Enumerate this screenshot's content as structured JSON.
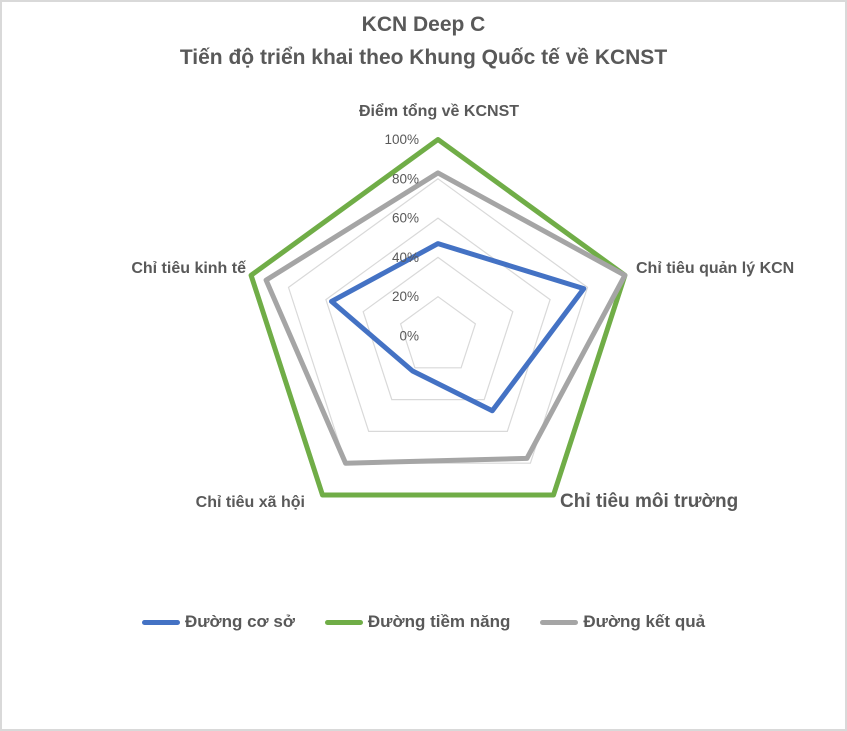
{
  "chart_data": {
    "type": "radar",
    "title": "KCN Deep C",
    "subtitle": "Tiến độ triển khai theo Khung Quốc tế về KCNST",
    "categories": [
      "Điểm tổng về KCNST",
      "Chỉ tiêu quản lý KCN",
      "Chỉ tiêu môi trường",
      "Chỉ tiêu xã hội",
      "Chỉ tiêu kinh tế"
    ],
    "series": [
      {
        "name": "Đường cơ sở",
        "color": "#4472C4",
        "values": [
          47,
          78,
          47,
          22,
          57
        ]
      },
      {
        "name": "Đường tiềm năng",
        "color": "#70AD47",
        "values": [
          100,
          100,
          100,
          100,
          100
        ]
      },
      {
        "name": "Đường kết quả",
        "color": "#A5A5A5",
        "values": [
          83,
          100,
          77,
          80,
          92
        ]
      }
    ],
    "ticks": [
      "0%",
      "20%",
      "40%",
      "60%",
      "80%",
      "100%"
    ],
    "tick_values": [
      0,
      20,
      40,
      60,
      80,
      100
    ],
    "rlim": [
      0,
      100
    ],
    "grid": true,
    "gridline_color": "#d9d9d9",
    "text_color": "#595959",
    "legend_position": "bottom"
  }
}
